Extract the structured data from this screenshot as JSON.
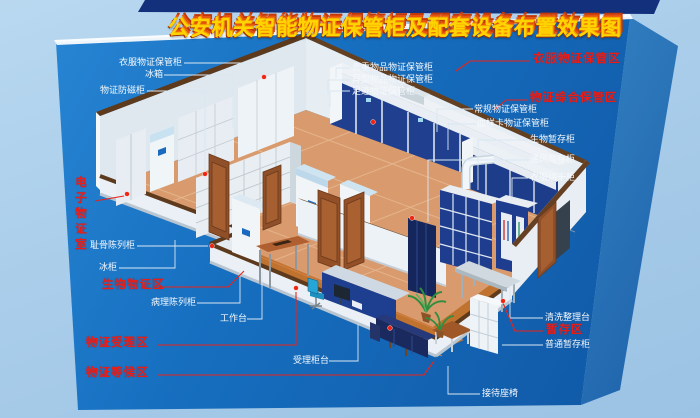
{
  "title": "公安机关智能物证保管柜及配套设备布置效果图",
  "zones": {
    "clothes_zone": "衣服物证保管区",
    "comprehensive_zone": "物证综合保管区",
    "temp_zone": "暂存区",
    "electronic_room": "电子物证室",
    "biological_zone": "生物物证区",
    "acceptance_zone": "物证受理区",
    "waiting_zone": "物证等候区"
  },
  "cabinets": {
    "clothes_cabinet": "衣服物证保管柜",
    "fridge": "冰箱",
    "antimagnetic_cabinet": "物证防磁柜",
    "pubic_bone_display": "耻骨陈列柜",
    "freezer": "冰柜",
    "pathology_display": "病理陈列柜",
    "worktable": "工作台",
    "reception_counter": "受理柜台",
    "valuables_cabinet": "贵重物品物证保管柜",
    "irregular_items_cabinet": "异型物品物证保管柜",
    "footprint_cabinet": "足迹物证保管柜",
    "regular_cabinet": "常规物证保管柜",
    "blood_sample_cabinet": "血样卡物证保管柜",
    "bio_temp_cabinet": "生物暂存柜",
    "ventilated_temp_cabinet": "通风暂存柜",
    "clothes_dryer_cabinet": "衣服烘干柜",
    "cleaning_table": "清洗整理台",
    "ordinary_temp_cabinet": "普通暂存柜",
    "reception_seats": "接待座椅"
  },
  "colors": {
    "background_light_blue": "#a9cdea",
    "board_blue": "#176fc0",
    "banner_navy": "#12307c",
    "title_yellow": "#ffd400",
    "title_shadow_orange": "#e85410",
    "zone_label_red": "#ed1d16",
    "equipment_label_white": "#f4f9fd",
    "wall_top_brown": "#5e3a1d",
    "floor_salmon": "#d99b6e",
    "floor_wood": "#c0722f",
    "cabinet_navy": "#20408f",
    "marker_red": "#f12513"
  }
}
